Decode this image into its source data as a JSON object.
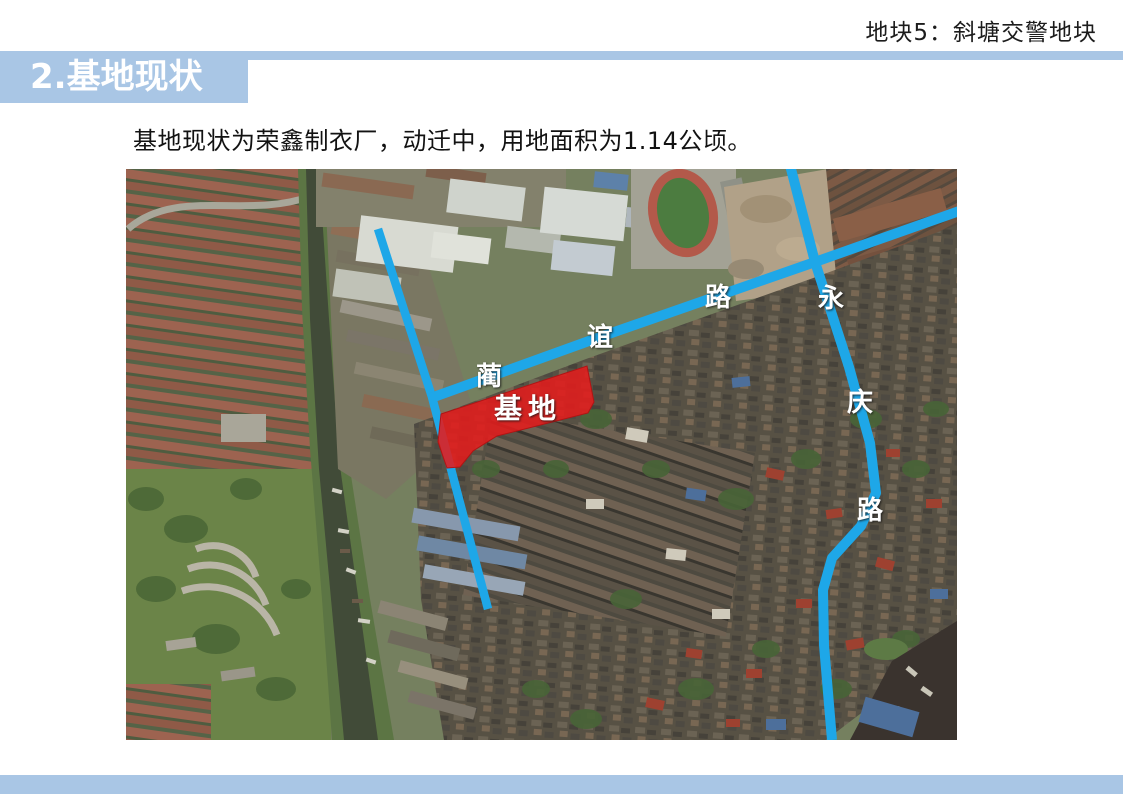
{
  "slide": {
    "corner_label": "地块5：斜塘交警地块",
    "section_title": "2.基地现状",
    "body_text": "基地现状为荣鑫制衣厂，动迁中，用地面积为1.14公顷。"
  },
  "colors": {
    "accent_blue": "#a9c6e5",
    "road_blue": "#1ea7e8",
    "site_red": "#e41d1d",
    "title_text_white": "#ffffff"
  },
  "map": {
    "site_label": "基地",
    "roads": [
      {
        "name": "蔺谊路",
        "chars": [
          "蔺",
          "谊",
          "路"
        ]
      },
      {
        "name": "永庆路",
        "chars": [
          "永",
          "庆",
          "路"
        ]
      }
    ]
  }
}
